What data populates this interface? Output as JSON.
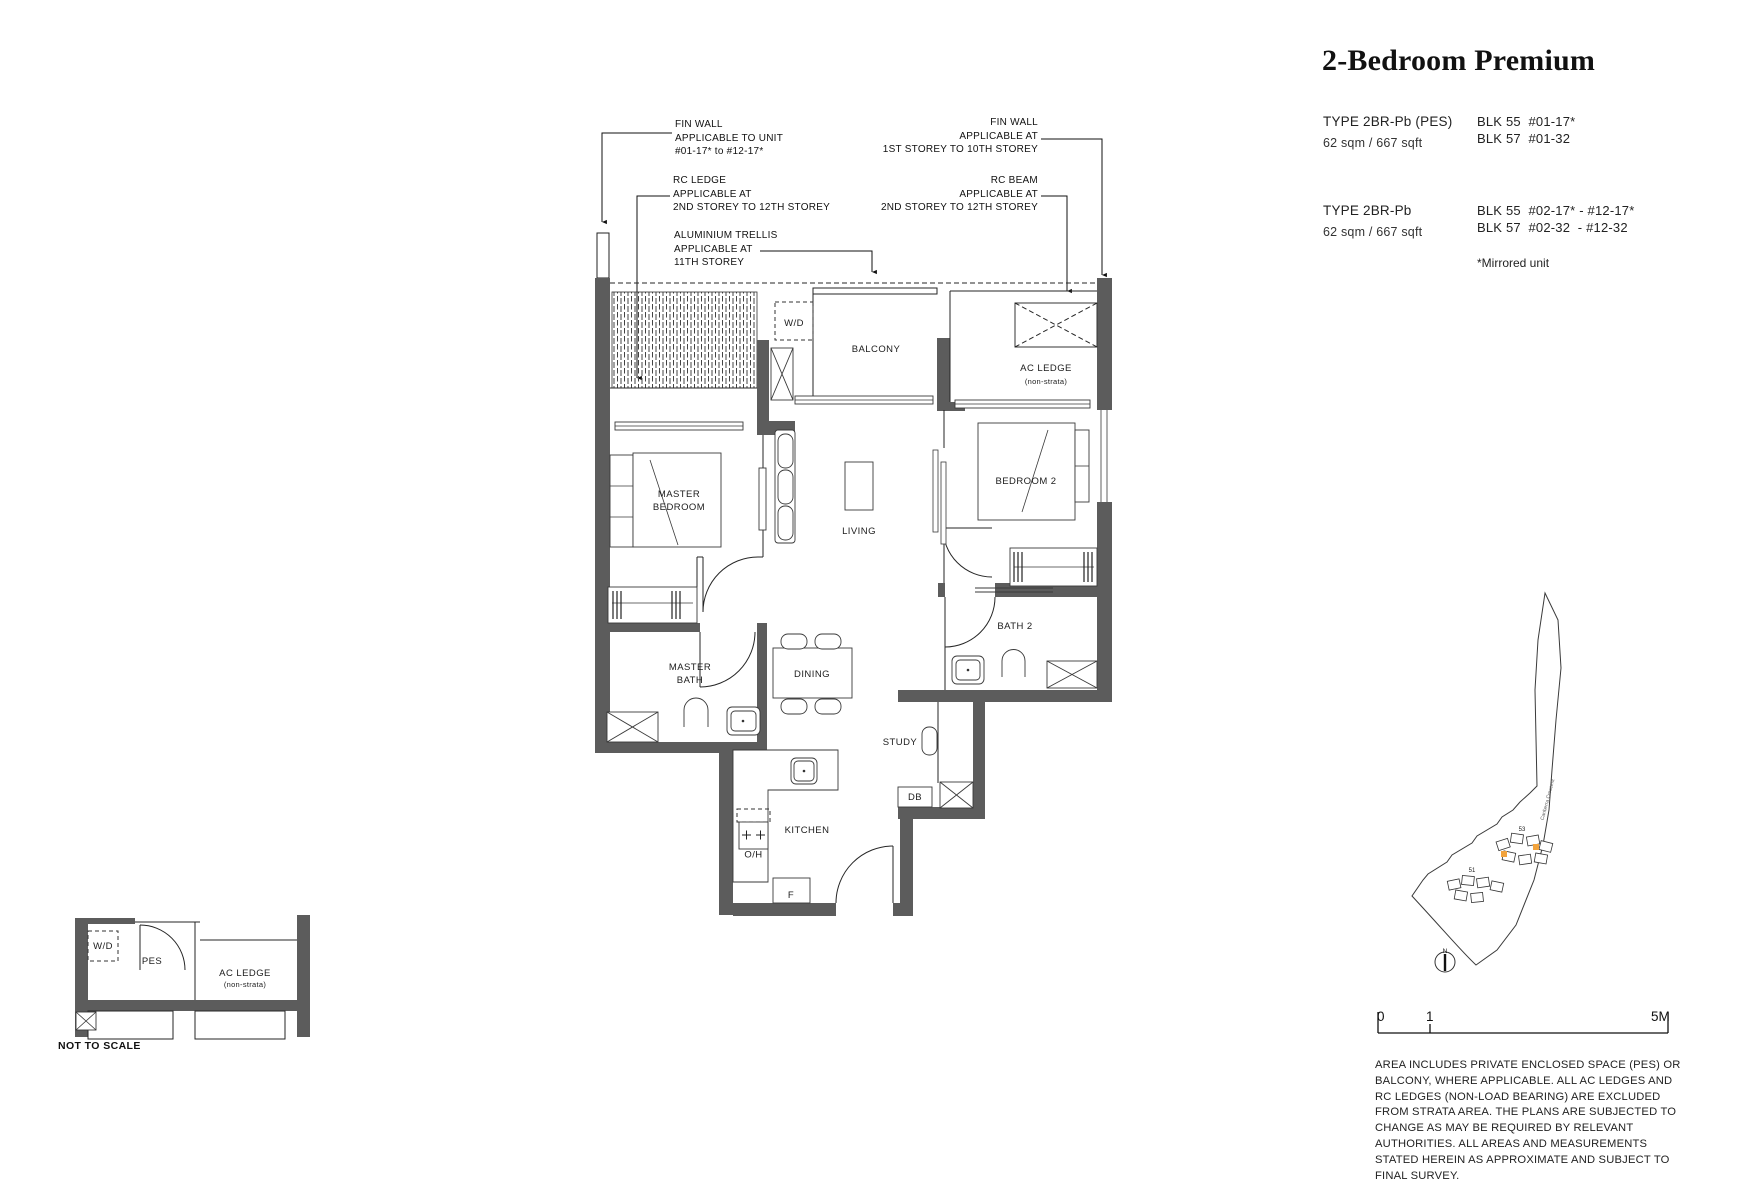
{
  "header": {
    "title": "2-Bedroom Premium"
  },
  "unit_info": {
    "row1": {
      "type": "TYPE 2BR-Pb (PES)",
      "area": "62 sqm / 667 sqft",
      "blk_line1": "BLK 55  #01-17*",
      "blk_line2": "BLK 57  #01-32"
    },
    "row2": {
      "type": "TYPE 2BR-Pb",
      "area": "62 sqm / 667 sqft",
      "blk_line1": "BLK 55  #02-17* - #12-17*",
      "blk_line2": "BLK 57  #02-32  - #12-32"
    },
    "mirror_note": "*Mirrored unit"
  },
  "callouts": {
    "fin_wall_left": {
      "l1": "FIN WALL",
      "l2": "APPLICABLE TO UNIT",
      "l3": "#01-17* to #12-17*"
    },
    "rc_ledge": {
      "l1": "RC LEDGE",
      "l2": "APPLICABLE AT",
      "l3": "2ND STOREY TO 12TH STOREY"
    },
    "aluminium_trellis": {
      "l1": "ALUMINIUM TRELLIS",
      "l2": "APPLICABLE AT",
      "l3": "11TH STOREY"
    },
    "fin_wall_right": {
      "l1": "FIN WALL",
      "l2": "APPLICABLE AT",
      "l3": "1ST STOREY TO 10TH  STOREY"
    },
    "rc_beam": {
      "l1": "RC BEAM",
      "l2": "APPLICABLE AT",
      "l3": "2ND STOREY TO 12TH  STOREY"
    }
  },
  "rooms": {
    "wd": "W/D",
    "balcony": "BALCONY",
    "ac_ledge": "AC LEDGE",
    "ac_ledge_sub": "(non-strata)",
    "master_bedroom_l1": "MASTER",
    "master_bedroom_l2": "BEDROOM",
    "living": "LIVING",
    "bedroom2": "BEDROOM 2",
    "bath2": "BATH 2",
    "master_bath_l1": "MASTER",
    "master_bath_l2": "BATH",
    "dining": "DINING",
    "study": "STUDY",
    "db": "DB",
    "kitchen": "KITCHEN",
    "hob": "H/O",
    "fridge": "F"
  },
  "key_plan": {
    "wd": "W/D",
    "pes": "PES",
    "ac_ledge": "AC LEDGE",
    "ac_ledge_sub": "(non-strata)",
    "note": "NOT TO SCALE"
  },
  "site_map": {
    "block_53": "53",
    "block_51": "51",
    "street": "Canberra Crescent",
    "north": "N",
    "highlight_color": "#F2A33C"
  },
  "scale_bar": {
    "t0": "0",
    "t1": "1",
    "t2": "5M"
  },
  "disclaimer": [
    "AREA INCLUDES PRIVATE ENCLOSED SPACE (PES) OR",
    "BALCONY, WHERE APPLICABLE. ALL AC LEDGES AND",
    "RC LEDGES (NON-LOAD BEARING) ARE EXCLUDED",
    "FROM STRATA AREA. THE PLANS ARE SUBJECTED TO",
    "CHANGE AS MAY BE REQUIRED BY RELEVANT",
    "AUTHORITIES. ALL AREAS AND MEASUREMENTS",
    "STATED HEREIN AS APPROXIMATE AND SUBJECT TO",
    "FINAL SURVEY."
  ]
}
